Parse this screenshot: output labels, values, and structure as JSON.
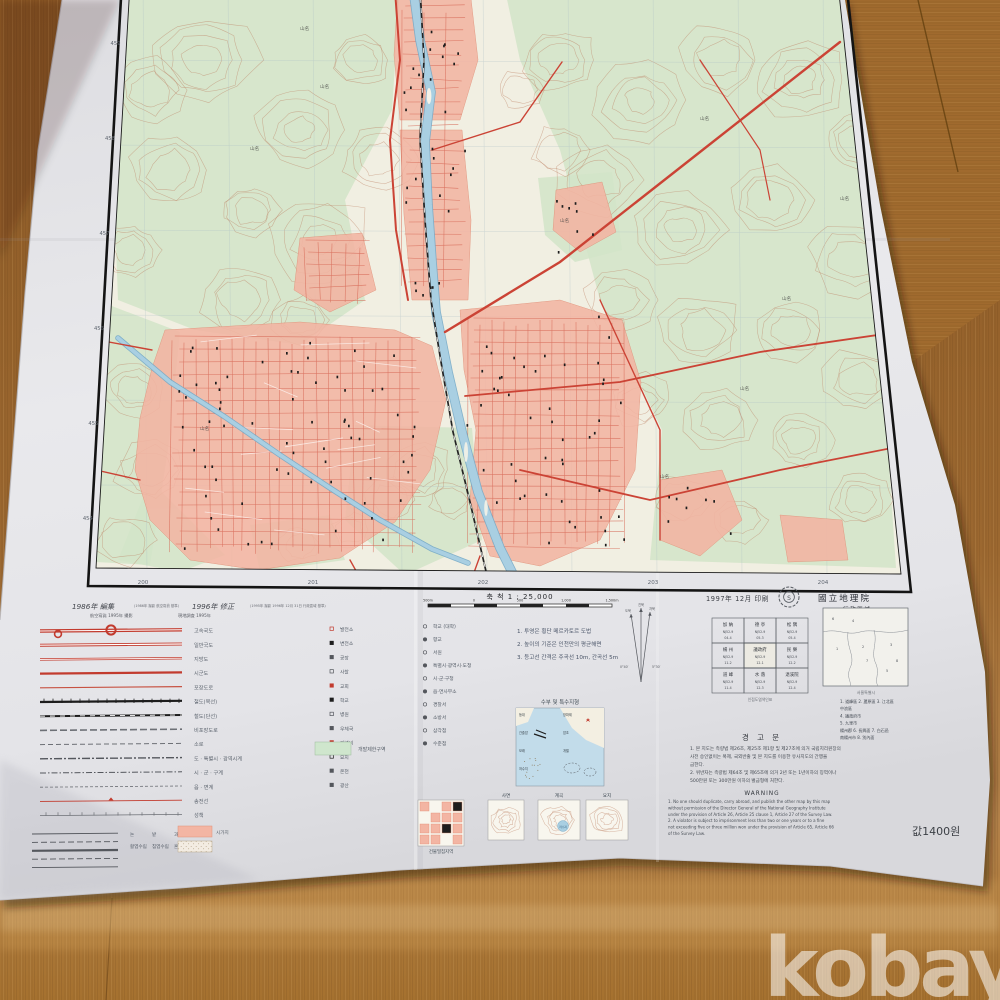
{
  "photo": {
    "watermark": "kobay"
  },
  "colors": {
    "wood_base": "#9a6630",
    "wood_light": "#c0904e",
    "wood_dark": "#74491c",
    "paper": "#e6e6e9",
    "paper_shade": "#cfcfd4",
    "map_bg": "#f1efe2",
    "veg": "#d2e4c8",
    "contour": "#bd8265",
    "water_fill": "#a9cfe2",
    "water_edge": "#76aac8",
    "urban_fill": "#f3b5a3",
    "urban_edge": "#e08f77",
    "road_red": "#cb4335",
    "street_red": "#d4604e",
    "rail_black": "#222222",
    "neatline": "#1a1a1a",
    "grid_gray": "#a9bcc4",
    "margin_text": "#5f6670",
    "legend_text": "#59616b",
    "greenbelt": "#cfe6cd",
    "watermark": "rgba(255,255,255,0.55)"
  },
  "map_margin": {
    "bottom_grid_labels": [
      "200",
      "201",
      "202",
      "203",
      "204"
    ],
    "left_grid_labels": [
      "459",
      "458",
      "457",
      "456",
      "455",
      "454"
    ]
  },
  "legend": {
    "edition": {
      "edit": "1986年 編集",
      "edit_note": "(1986年 撮影 航空寫眞 基準)",
      "revise": "1996年 修正",
      "revise_note": "(1995年 撮影 1996年 12月 31日 行政區域 基準)",
      "sub_left": "航空寫眞 1995年 撮影",
      "sub_right": "現地調査 1995年"
    },
    "line_rows": [
      {
        "type": "hwy",
        "label": "고속국도"
      },
      {
        "type": "road2",
        "label": "일반국도"
      },
      {
        "type": "road2t",
        "label": "지방도"
      },
      {
        "type": "roadthick",
        "label": "시군도"
      },
      {
        "type": "roadthin",
        "label": "포장도로"
      },
      {
        "type": "rail2",
        "label": "철도(복선)"
      },
      {
        "type": "rail1",
        "label": "철도(단선)"
      },
      {
        "type": "dashwide",
        "label": "비포장도로"
      },
      {
        "type": "dashmid",
        "label": "소로"
      },
      {
        "type": "dashdot1",
        "label": "도 · 특별시 · 광역시계"
      },
      {
        "type": "dashdot2",
        "label": "시 · 군 · 구계"
      },
      {
        "type": "dashfine",
        "label": "읍 · 면계"
      },
      {
        "type": "redline",
        "label": "송전선"
      },
      {
        "type": "fence",
        "label": "성책"
      }
    ],
    "point_rows_a": [
      "발전소",
      "변전소",
      "공장",
      "사찰",
      "교회",
      "학교",
      "병원",
      "우체국",
      "기념비",
      "묘지",
      "온천",
      "광산"
    ],
    "point_rows_b": [
      "학교 (대학)",
      "향교",
      "서원",
      "특별시·광역시·도청",
      "시·군·구청",
      "읍·면사무소",
      "경찰서",
      "소방서",
      "삼각점",
      "수준점"
    ],
    "pattern_labels": [
      "논",
      "밭",
      "과수원",
      "활엽수림",
      "침엽수림",
      "혼합림"
    ],
    "builtup_label": "시가지",
    "greenbelt_label": "개발제한구역",
    "scale_title": "축 척  1 : 25,000",
    "scale_ticks": [
      "500m",
      "0",
      "500",
      "1,000",
      "1,500m"
    ],
    "notes": [
      "1. 투영은 횡단 메르카토르 도법",
      "2. 높이의 기준은 인천만의 평균해면",
      "3. 등고선 간격은 주곡선 10m, 간곡선 5m"
    ],
    "declination_labels": [
      "진북",
      "도북",
      "자북"
    ],
    "declination_values": [
      "0°40′",
      "5°30′"
    ],
    "water_diagram": {
      "title": "수부 및 특수지형",
      "labels": [
        "등대",
        "방파제",
        "간출암",
        "암초",
        "모래",
        "개펄",
        "저수지"
      ]
    },
    "terrain_examples": {
      "labels": [
        "사면",
        "계곡",
        "요지"
      ],
      "pond_label": "저수지"
    },
    "block_diagram_caption": "건물밀집지역"
  },
  "publication": {
    "printed": "1997年 12月 印刷",
    "agency": "國立地理院",
    "admin_title": "行政區域",
    "price": "값1400원"
  },
  "index_grid": {
    "caption": "인접도엽색인표",
    "cells": [
      {
        "name": "加 納",
        "code1": "NJ52-9",
        "code2": "04-4"
      },
      {
        "name": "德 亭",
        "code1": "NJ52-9",
        "code2": "05-3"
      },
      {
        "name": "松 隅",
        "code1": "NJ52-9",
        "code2": "05-4"
      },
      {
        "name": "楊 州",
        "code1": "NJ52-9",
        "code2": "11-2"
      },
      {
        "name": "議政府",
        "code1": "NJ52-9",
        "code2": "12-1"
      },
      {
        "name": "民 樂",
        "code1": "NJ52-9",
        "code2": "12-2"
      },
      {
        "name": "道 峰",
        "code1": "NJ52-9",
        "code2": "11-4"
      },
      {
        "name": "水 落",
        "code1": "NJ52-9",
        "code2": "12-3"
      },
      {
        "name": "退溪院",
        "code1": "NJ52-9",
        "code2": "12-4"
      }
    ]
  },
  "admin_map": {
    "caption": "서울특별시",
    "list": [
      "1. 道峰區   2. 蘆原區   3. 江北區",
      "中浪區",
      "4. 議政府市",
      "5. 九里市",
      "楊州郡   6. 長興面   7. 白石邑",
      "南楊州市   8. 別內面"
    ]
  },
  "warning": {
    "title": "경 고 문",
    "korean": [
      "1. 본 지도는 측량법 제26조, 제25조 제1항 및 제27조에 의거 국립지리원장의",
      "   사전 승인없이는 복제, 국외반출 및 본 지도를 이용한 유사지도의 간행을",
      "   금한다.",
      "2. 위반자는 측량법 제64조 및 제65조에 의거 2년 또는 1년이하의 징역이나",
      "   500만원 또는 300만원 이하의 벌금형에 처한다."
    ],
    "en_title": "WARNING",
    "english": [
      "1. No one should duplicate, carry abroad, and publish the other map by this map",
      "without permission of the Director General of the National Geography Institute",
      "under the provision of Article 26, Article 25 clause 1, Article 27 of the Survey Law.",
      "2. A violator is subject to imprisonment less than two or one years or to a fine",
      "not exceeding five or three million won under the provision of Article 65, Article 66",
      "of the Survey Law."
    ]
  }
}
